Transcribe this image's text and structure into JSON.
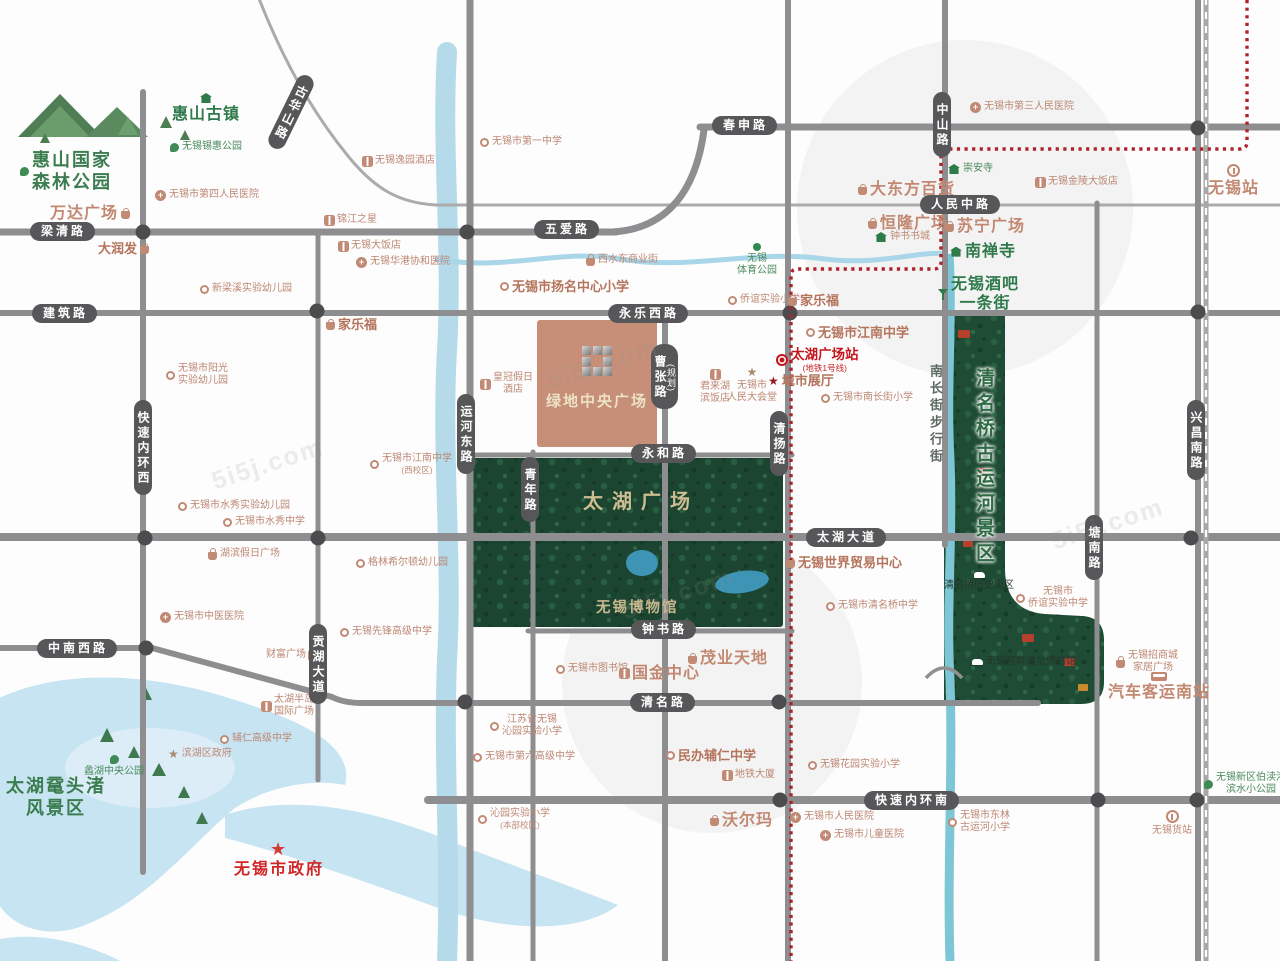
{
  "watermark": "5i5j.com",
  "colors": {
    "road": "#8e8e90",
    "road_dot": "#4c4c4e",
    "pill_bg": "#57575a",
    "river": "#b5dbea",
    "canal": "#7cc6d6",
    "lake": "#c7e4f2",
    "park_green": "#1b4530",
    "corridor_green": "#1f4c34",
    "block_salmon": "#c78f78",
    "poi_brown": "#bd8773",
    "poi_brown_bold": "#c28872",
    "poi_green": "#2f7a4a",
    "metro_red": "#c5161d",
    "route_dotted": "#ae232a",
    "khaki_label": "#cdbd92"
  },
  "map": {
    "greenland": {
      "title": "绿地中央广场"
    },
    "road_pills": [
      {
        "id": "liangqing-rd",
        "label": "梁清路",
        "x": 30,
        "y": 222
      },
      {
        "id": "jianzhu-rd",
        "label": "建筑路",
        "x": 32,
        "y": 304
      },
      {
        "id": "wuai-rd",
        "label": "五爱路",
        "x": 534,
        "y": 220
      },
      {
        "id": "chunshen-rd",
        "label": "春申路",
        "x": 712,
        "y": 116
      },
      {
        "id": "yongle-west-rd",
        "label": "永乐西路",
        "x": 608,
        "y": 304
      },
      {
        "id": "yonghe-rd",
        "label": "永和路",
        "x": 631,
        "y": 444
      },
      {
        "id": "zhongshu-rd",
        "label": "钟书路",
        "x": 631,
        "y": 620
      },
      {
        "id": "qingming-rd",
        "label": "清名路",
        "x": 630,
        "y": 693
      },
      {
        "id": "taihu-ave",
        "label": "太湖大道",
        "x": 806,
        "y": 528
      },
      {
        "id": "kuaisu-neihuan-south",
        "label": "快速内环南",
        "x": 864,
        "y": 791
      },
      {
        "id": "zhongnan-west-rd",
        "label": "中南西路",
        "x": 37,
        "y": 639
      },
      {
        "id": "renmin-middle-rd",
        "label": "人民中路",
        "x": 920,
        "y": 195
      },
      {
        "id": "zhongshan-rd",
        "label": "中山路",
        "x": 933,
        "y": 92,
        "v": 1
      },
      {
        "id": "yunhe-east-rd",
        "label": "运河东路",
        "x": 457,
        "y": 394,
        "v": 1
      },
      {
        "id": "caozhang-rd",
        "label": "曹张路",
        "sub": "(规划)",
        "x": 651,
        "y": 344,
        "v": 1
      },
      {
        "id": "qingyang-rd",
        "label": "清扬路",
        "x": 770,
        "y": 411,
        "v": 1
      },
      {
        "id": "qingnian-rd",
        "label": "青年路",
        "x": 521,
        "y": 457,
        "v": 1
      },
      {
        "id": "kuaisu-neihuan-west",
        "label": "快速内环西",
        "x": 134,
        "y": 400,
        "v": 1
      },
      {
        "id": "gonghu-ave",
        "label": "贡湖大道",
        "x": 309,
        "y": 624,
        "v": 1
      },
      {
        "id": "tangnan-rd",
        "label": "塘南路",
        "x": 1085,
        "y": 515,
        "v": 1
      },
      {
        "id": "xingchang-south-rd",
        "label": "兴昌南路",
        "x": 1187,
        "y": 400,
        "v": 1
      },
      {
        "id": "guhuashan-rd",
        "label": "古华山路",
        "x": 282,
        "y": 72,
        "v": 1,
        "rot": 26
      }
    ],
    "area_labels": [
      {
        "id": "taihu-square",
        "text": "太湖广场",
        "x": 583,
        "y": 485,
        "cls": "khaki-xl"
      },
      {
        "id": "wuxi-museum",
        "text": "无锡博物馆",
        "x": 596,
        "y": 596,
        "cls": "khaki-l"
      },
      {
        "id": "qingmingqiao-scenic-area",
        "text": "清名桥古运河景区",
        "x": 970,
        "y": 368,
        "cls": "green-vert"
      },
      {
        "id": "nanchang-pedestrian-street",
        "text": "南长街步行街",
        "x": 926,
        "y": 364,
        "cls": "gray-vert"
      }
    ],
    "pois": [
      {
        "id": "huishan-for-park",
        "x": 20,
        "y": 150,
        "icon": "leaf",
        "lines": [
          "惠山国家",
          "森林公园"
        ],
        "cls": "green-xl"
      },
      {
        "id": "huishan-ancient-town",
        "x": 172,
        "y": 93,
        "icon": "temple",
        "top": 1,
        "lines": [
          "惠山古镇"
        ],
        "cls": "green-l"
      },
      {
        "id": "xihui-park",
        "x": 170,
        "y": 141,
        "icon": "leaf",
        "lines": [
          "无锡锡惠公园"
        ],
        "cls": "green-s"
      },
      {
        "id": "wanda-plaza",
        "x": 50,
        "y": 204,
        "icon": "bag",
        "iconRight": 1,
        "lines": [
          "万达广场"
        ],
        "cls": "l"
      },
      {
        "id": "rt-mart",
        "x": 98,
        "y": 241,
        "icon": "bag",
        "iconRight": 1,
        "lines": [
          "大润发"
        ],
        "cls": "m"
      },
      {
        "id": "no4-peoples-hospital",
        "x": 155,
        "y": 189,
        "icon": "cross",
        "lines": [
          "无锡市第四人民医院"
        ],
        "cls": "s"
      },
      {
        "id": "xinliangxi-kindergarten",
        "x": 200,
        "y": 283,
        "icon": "ring",
        "lines": [
          "新梁溪实验幼儿园"
        ],
        "cls": "s"
      },
      {
        "id": "jinjiang-inn",
        "x": 325,
        "y": 214,
        "icon": "bldg",
        "lines": [
          "锦江之星"
        ],
        "cls": "s"
      },
      {
        "id": "wuxi-grand-hotel",
        "x": 339,
        "y": 240,
        "icon": "bldg",
        "lines": [
          "无锡大饭店"
        ],
        "cls": "s"
      },
      {
        "id": "huagang-xiehe-hospital",
        "x": 356,
        "y": 256,
        "icon": "cross",
        "lines": [
          "无锡华港协和医院"
        ],
        "cls": "s"
      },
      {
        "id": "yiyuan-hotel",
        "x": 363,
        "y": 155,
        "icon": "bldg",
        "lines": [
          "无锡逸园酒店"
        ],
        "cls": "s"
      },
      {
        "id": "no1-middle-school",
        "x": 480,
        "y": 136,
        "icon": "ring",
        "lines": [
          "无锡市第一中学"
        ],
        "cls": "s"
      },
      {
        "id": "yangming-central-primary",
        "x": 500,
        "y": 279,
        "icon": "ring",
        "lines": [
          "无锡市扬名中心小学"
        ],
        "cls": "m"
      },
      {
        "id": "xishuidong-commercial-street",
        "x": 586,
        "y": 254,
        "icon": "bag",
        "lines": [
          "西水东商业街"
        ],
        "cls": "s"
      },
      {
        "id": "wuxi-sports-park",
        "x": 737,
        "y": 243,
        "icon": "dot",
        "top": 1,
        "lines": [
          "无锡",
          "体育公园"
        ],
        "cls": "green-s"
      },
      {
        "id": "no3-peoples-hospital",
        "x": 970,
        "y": 101,
        "icon": "cross",
        "lines": [
          "无锡市第三人民医院"
        ],
        "cls": "s"
      },
      {
        "id": "dadongfang-store",
        "x": 858,
        "y": 180,
        "icon": "bag",
        "lines": [
          "大东方百货"
        ],
        "cls": "l"
      },
      {
        "id": "chongan-temple",
        "x": 948,
        "y": 163,
        "icon": "temple",
        "lines": [
          "崇安寺"
        ],
        "cls": "green-s"
      },
      {
        "id": "jinling-hotel",
        "x": 1036,
        "y": 176,
        "icon": "bldg",
        "lines": [
          "无锡金陵大饭店"
        ],
        "cls": "s"
      },
      {
        "id": "wuxi-railway-station",
        "x": 1208,
        "y": 164,
        "icon": "train",
        "top": 1,
        "lines": [
          "无锡站"
        ],
        "cls": "l"
      },
      {
        "id": "hanglung-plaza",
        "x": 868,
        "y": 214,
        "icon": "bag",
        "lines": [
          "恒隆广场"
        ],
        "cls": "l"
      },
      {
        "id": "suning-plaza",
        "x": 945,
        "y": 217,
        "icon": "bag",
        "lines": [
          "苏宁广场"
        ],
        "cls": "l"
      },
      {
        "id": "zhongshu-bookmall",
        "x": 875,
        "y": 231,
        "icon": "temple",
        "lines": [
          "钟书书城"
        ],
        "cls": "s"
      },
      {
        "id": "nanchan-temple",
        "x": 950,
        "y": 242,
        "icon": "temple",
        "lines": [
          "南禅寺"
        ],
        "cls": "green-l"
      },
      {
        "id": "wuxi-bar-street",
        "x": 938,
        "y": 275,
        "icon": "martini",
        "lines": [
          "无锡酒吧",
          "一条街"
        ],
        "cls": "green-l"
      },
      {
        "id": "carrefour-east",
        "x": 788,
        "y": 293,
        "icon": "bag",
        "lines": [
          "家乐福"
        ],
        "cls": "m"
      },
      {
        "id": "qiaoyi-exp-primary",
        "x": 728,
        "y": 294,
        "icon": "ring",
        "lines": [
          "侨谊实验小学"
        ],
        "cls": "s"
      },
      {
        "id": "carrefour-west",
        "x": 326,
        "y": 317,
        "icon": "bag",
        "lines": [
          "家乐福"
        ],
        "cls": "m"
      },
      {
        "id": "jiangnan-middle-school",
        "x": 806,
        "y": 325,
        "icon": "ring",
        "lines": [
          "无锡市江南中学"
        ],
        "cls": "m"
      },
      {
        "id": "taihu-square-metro",
        "x": 776,
        "y": 347,
        "icon": "metro",
        "lines": [
          "太湖广场站"
        ],
        "sub": "(地铁1号线)",
        "cls": "red"
      },
      {
        "id": "city-exhibition-hall",
        "x": 768,
        "y": 373,
        "icon": "star-dred",
        "lines": [
          "城市展厅"
        ],
        "cls": "m"
      },
      {
        "id": "junlai-hubin-hotel",
        "x": 700,
        "y": 370,
        "icon": "bldg",
        "top": 1,
        "lines": [
          "君来湖",
          "滨饭店"
        ],
        "cls": "s"
      },
      {
        "id": "peoples-assembly-hall",
        "x": 727,
        "y": 366,
        "icon": "star",
        "top": 1,
        "lines": [
          "无锡市",
          "人民大会堂"
        ],
        "cls": "s"
      },
      {
        "id": "crowne-plaza-hotel",
        "x": 481,
        "y": 372,
        "icon": "bldg",
        "lines": [
          "皇冠假日",
          "酒店"
        ],
        "cls": "s"
      },
      {
        "id": "nanchangjie-primary",
        "x": 821,
        "y": 392,
        "icon": "ring",
        "lines": [
          "无锡市南长街小学"
        ],
        "cls": "s"
      },
      {
        "id": "jiangnan-middle-west",
        "x": 370,
        "y": 453,
        "icon": "ring",
        "lines": [
          "无锡市江南中学"
        ],
        "sub": "(西校区)",
        "cls": "s"
      },
      {
        "id": "yangguang-kindergarten",
        "x": 166,
        "y": 363,
        "icon": "ring",
        "lines": [
          "无锡市阳光",
          "实验幼儿园"
        ],
        "cls": "s"
      },
      {
        "id": "shuixiu-kindergarten",
        "x": 178,
        "y": 500,
        "icon": "ring",
        "lines": [
          "无锡市水秀实验幼儿园"
        ],
        "cls": "s"
      },
      {
        "id": "shuixiu-middle-school",
        "x": 223,
        "y": 516,
        "icon": "ring",
        "lines": [
          "无锡市水秀中学"
        ],
        "cls": "s"
      },
      {
        "id": "hubin-holiday-plaza",
        "x": 208,
        "y": 548,
        "icon": "bag",
        "lines": [
          "湖滨假日广场"
        ],
        "cls": "s"
      },
      {
        "id": "gelin-kindergarten",
        "x": 356,
        "y": 557,
        "icon": "ring",
        "lines": [
          "格林希尔顿幼儿园"
        ],
        "cls": "s"
      },
      {
        "id": "xianfeng-high-school",
        "x": 340,
        "y": 626,
        "icon": "ring",
        "lines": [
          "无锡先锋高级中学"
        ],
        "cls": "s"
      },
      {
        "id": "tcm-hospital",
        "x": 160,
        "y": 611,
        "icon": "cross",
        "lines": [
          "无锡市中医医院"
        ],
        "cls": "s"
      },
      {
        "id": "caifu-plaza",
        "x": 266,
        "y": 649,
        "icon": "bldg",
        "iconRight": 1,
        "lines": [
          "财富广场"
        ],
        "cls": "s"
      },
      {
        "id": "taihu-peninsula-plaza",
        "x": 262,
        "y": 694,
        "icon": "bldg",
        "lines": [
          "太湖半岛",
          "国际广场"
        ],
        "cls": "s"
      },
      {
        "id": "furen-high-school",
        "x": 220,
        "y": 733,
        "icon": "ring",
        "lines": [
          "辅仁高级中学"
        ],
        "cls": "s"
      },
      {
        "id": "binhu-district-gov",
        "x": 168,
        "y": 748,
        "icon": "star",
        "lines": [
          "滨湖区政府"
        ],
        "cls": "s"
      },
      {
        "id": "lihu-central-park",
        "x": 84,
        "y": 755,
        "icon": "leaf",
        "top": 1,
        "lines": [
          "蠡湖中央公园"
        ],
        "cls": "green-s"
      },
      {
        "id": "yuantouzhu-scenic",
        "x": 6,
        "y": 776,
        "icon": "none",
        "lines": [
          "太湖鼋头渚",
          "风景区"
        ],
        "cls": "green-xl"
      },
      {
        "id": "wuxi-city-gov",
        "x": 234,
        "y": 840,
        "icon": "star-red",
        "top": 1,
        "lines": [
          "无锡市政府"
        ],
        "cls": "red-l"
      },
      {
        "id": "wuxi-library",
        "x": 556,
        "y": 663,
        "icon": "ring",
        "lines": [
          "无锡市图书馆"
        ],
        "cls": "s"
      },
      {
        "id": "guojin-center",
        "x": 620,
        "y": 664,
        "icon": "bldg",
        "lines": [
          "国金中心"
        ],
        "cls": "l"
      },
      {
        "id": "maoye-tiandi",
        "x": 688,
        "y": 649,
        "icon": "bag",
        "lines": [
          "茂业天地"
        ],
        "cls": "l"
      },
      {
        "id": "world-trade-center",
        "x": 786,
        "y": 555,
        "icon": "bag",
        "lines": [
          "无锡世界贸易中心"
        ],
        "cls": "m"
      },
      {
        "id": "qingmingqiao-middle",
        "x": 826,
        "y": 600,
        "icon": "ring",
        "lines": [
          "无锡市清名桥中学"
        ],
        "cls": "s"
      },
      {
        "id": "qinyuan-primary-js",
        "x": 490,
        "y": 714,
        "icon": "ring",
        "lines": [
          "江苏省无锡",
          "沁园实验小学"
        ],
        "cls": "s"
      },
      {
        "id": "no6-high-school",
        "x": 473,
        "y": 751,
        "icon": "ring",
        "lines": [
          "无锡市第六高级中学"
        ],
        "cls": "s"
      },
      {
        "id": "minban-furen-middle",
        "x": 666,
        "y": 748,
        "icon": "ring",
        "lines": [
          "民办辅仁中学"
        ],
        "cls": "m"
      },
      {
        "id": "ditie-tower",
        "x": 723,
        "y": 769,
        "icon": "bldg",
        "lines": [
          "地铁大厦"
        ],
        "cls": "s"
      },
      {
        "id": "huayuan-exp-primary",
        "x": 808,
        "y": 759,
        "icon": "ring",
        "lines": [
          "无锡花园实验小学"
        ],
        "cls": "s"
      },
      {
        "id": "qinyuan-primary",
        "x": 478,
        "y": 808,
        "icon": "ring",
        "lines": [
          "沁园实验小学"
        ],
        "sub": "(本部校区)",
        "cls": "s"
      },
      {
        "id": "walmart",
        "x": 710,
        "y": 811,
        "icon": "bag",
        "lines": [
          "沃尔玛"
        ],
        "cls": "l"
      },
      {
        "id": "peoples-hospital",
        "x": 790,
        "y": 811,
        "icon": "cross",
        "lines": [
          "无锡市人民医院"
        ],
        "cls": "s"
      },
      {
        "id": "childrens-hospital",
        "x": 820,
        "y": 829,
        "icon": "cross",
        "lines": [
          "无锡市儿童医院"
        ],
        "cls": "s"
      },
      {
        "id": "donglin-guyunhe-primary",
        "x": 948,
        "y": 810,
        "icon": "ring",
        "lines": [
          "无锡市东林",
          "古运河小学"
        ],
        "cls": "s"
      },
      {
        "id": "qingmingqiao-historic-block",
        "x": 944,
        "y": 572,
        "icon": "car",
        "top": 1,
        "lines": [
          "清名桥历史街区"
        ],
        "cls": "corridor"
      },
      {
        "id": "yaoqun-ruins-museum",
        "x": 972,
        "y": 656,
        "icon": "car",
        "lines": [
          "无锡窑群遗址博物馆"
        ],
        "cls": "corridor"
      },
      {
        "id": "qiaoyi-exp-middle",
        "x": 1016,
        "y": 586,
        "icon": "ring",
        "lines": [
          "无锡市",
          "侨谊实验中学"
        ],
        "cls": "s"
      },
      {
        "id": "zhaoshangcheng-home-plaza",
        "x": 1116,
        "y": 650,
        "icon": "bag",
        "lines": [
          "无锡招商城",
          "家居广场"
        ],
        "cls": "s"
      },
      {
        "id": "south-bus-station",
        "x": 1108,
        "y": 672,
        "icon": "bus",
        "top": 1,
        "lines": [
          "汽车客运南站"
        ],
        "cls": "l"
      },
      {
        "id": "bodugang-waterfront-park",
        "x": 1204,
        "y": 772,
        "icon": "leaf",
        "lines": [
          "无锡新区伯渎港",
          "滨水小公园"
        ],
        "cls": "green-s"
      },
      {
        "id": "wuxi-freight-station",
        "x": 1152,
        "y": 810,
        "icon": "train",
        "top": 1,
        "lines": [
          "无锡货站"
        ],
        "cls": "s"
      }
    ]
  }
}
